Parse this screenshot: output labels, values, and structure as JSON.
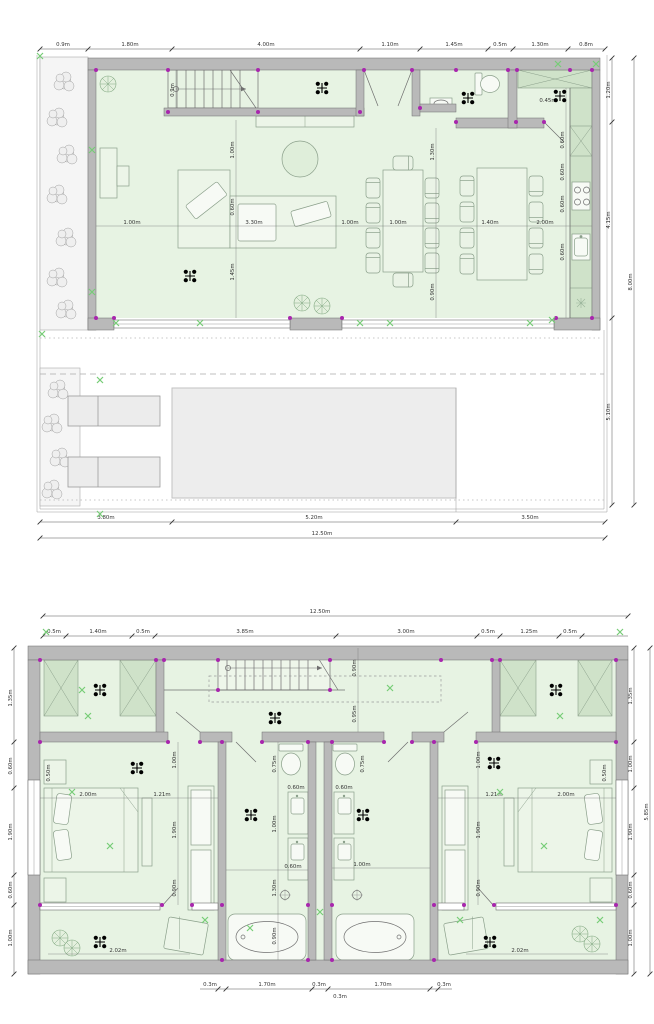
{
  "document_type": "architectural floor plans, two storeys",
  "colors": {
    "floor_green": "#e7f3e3",
    "cabinet_green": "#cfe2c9",
    "wall_gray": "#b9b9b9",
    "pool_gray": "#ededed",
    "junction_magenta": "#a826ad",
    "mark_green": "#76cc76",
    "dimension_text": "#333333"
  },
  "symbols": {
    "ceiling_light": "black four-dot cross luminaire",
    "wall_junction": "magenta node dot",
    "level_mark": "green x mark",
    "shrub": "gray outline planting",
    "plant": "green radial plant"
  },
  "plan1": {
    "dims_top": [
      "0.9m",
      "1.80m",
      "4.00m",
      "1.10m",
      "1.45m",
      "0.5m",
      "1.30m",
      "0.8m"
    ],
    "dims_bottom": [
      "3.80m",
      "5.20m",
      "3.50m"
    ],
    "total_width": "12.50m",
    "dims_right": [
      "1.20m",
      "4.15m",
      "5.10m"
    ],
    "depth_total": "8.00m",
    "interior": [
      "0.9m",
      "1.00m",
      "0.60m",
      "1.45m",
      "1.00m",
      "3.30m",
      "1.00m",
      "1.00m",
      "1.40m",
      "2.00m",
      "1.30m",
      "0.90m",
      "0.60m",
      "0.60m",
      "0.60m",
      "0.60m",
      "0.45m"
    ]
  },
  "plan2": {
    "total_width": "12.50m",
    "dims_top": [
      "0.5m",
      "1.40m",
      "0.5m",
      "3.85m",
      "3.00m",
      "0.5m",
      "1.25m",
      "0.5m"
    ],
    "dims_bottom": [
      "0.3m",
      "1.70m",
      "0.3m",
      "0.3m",
      "1.70m",
      "0.3m"
    ],
    "dims_left": [
      "1.35m",
      "0.60m",
      "1.90m",
      "0.60m",
      "1.00m"
    ],
    "dims_right": [
      "1.35m",
      "1.00m",
      "1.90m",
      "0.60m",
      "1.00m"
    ],
    "depth_total": "5.85m",
    "interior": [
      "0.90m",
      "0.95m",
      "2.00m",
      "1.21m",
      "1.00m",
      "1.90m",
      "0.90m",
      "0.50m",
      "0.75m",
      "1.00m",
      "1.30m",
      "0.90m",
      "0.60m",
      "0.60m",
      "0.60m",
      "1.00m",
      "1.21m",
      "2.00m",
      "1.00m",
      "1.90m",
      "0.90m",
      "0.50m",
      "2.02m",
      "2.02m",
      "0.75m"
    ]
  }
}
